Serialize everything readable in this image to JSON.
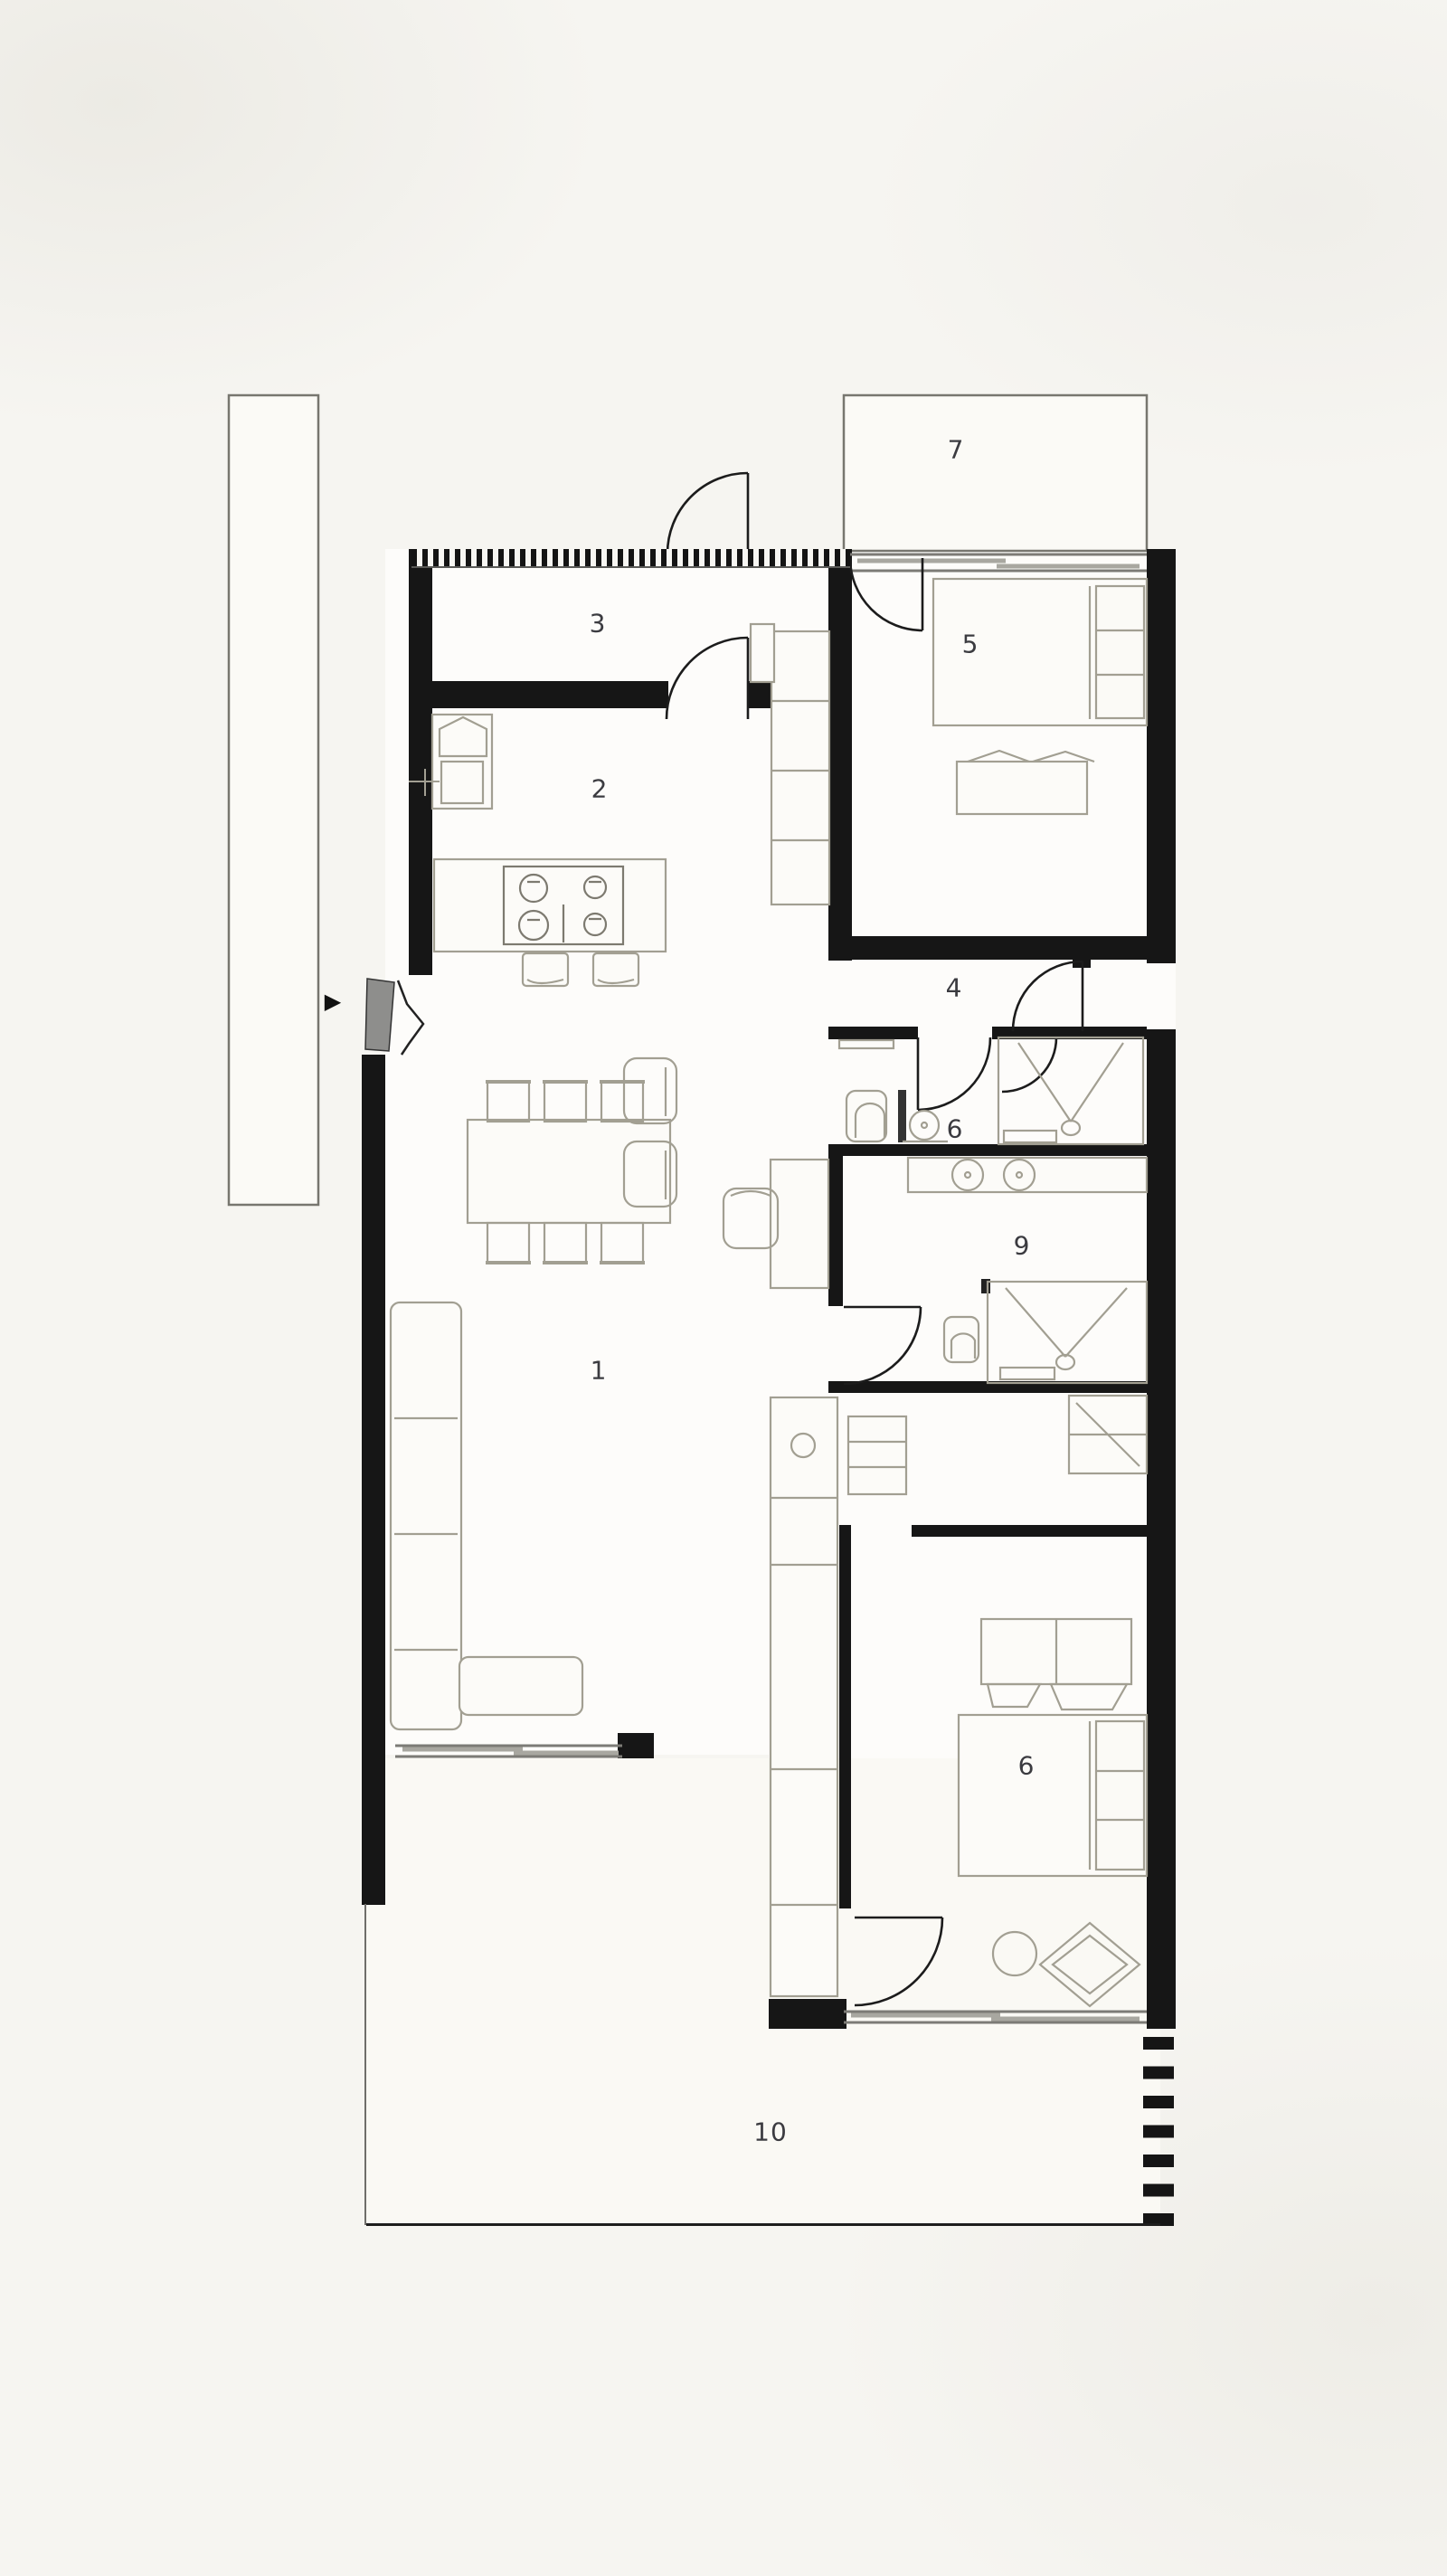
{
  "drawing": {
    "type": "residential-floor-plan",
    "background": "#f6f5f1",
    "wall_color": "#161616",
    "furniture_stroke_color": "#a29f92",
    "label_color": "#3b3b40",
    "entry_marker": "▶"
  },
  "rooms": [
    {
      "id": "living-room",
      "label": "1"
    },
    {
      "id": "kitchen",
      "label": "2"
    },
    {
      "id": "entry-hall",
      "label": "3"
    },
    {
      "id": "hallway",
      "label": "4"
    },
    {
      "id": "bedroom-main",
      "label": "5"
    },
    {
      "id": "bathroom",
      "label": "6"
    },
    {
      "id": "terrace-north",
      "label": "7"
    },
    {
      "id": "bathroom-ensuite",
      "label": "9"
    },
    {
      "id": "bedroom-south",
      "label": "6"
    },
    {
      "id": "terrace-south",
      "label": "10"
    }
  ]
}
